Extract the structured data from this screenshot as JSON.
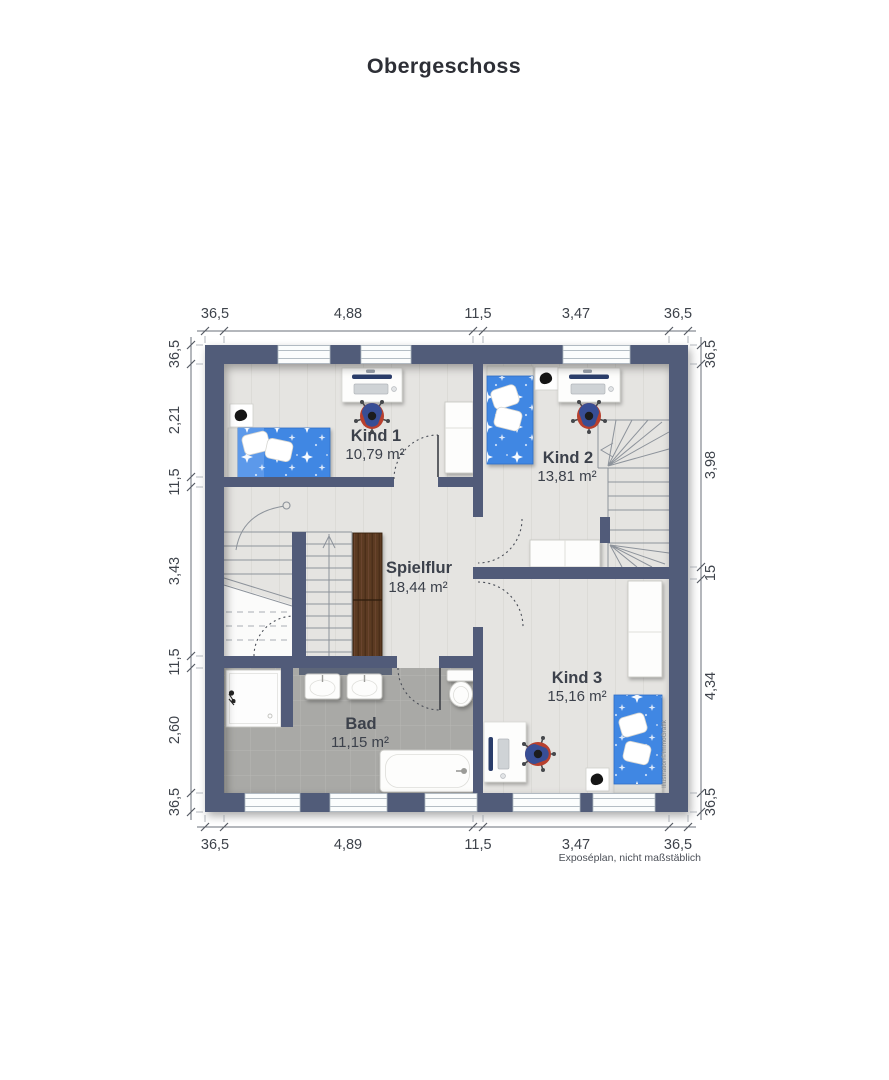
{
  "title": "Obergeschoss",
  "caption": "Exposéplan, nicht maßstäblich",
  "watermark": "Illustration©ImmoGrafik",
  "rooms": {
    "kind1": {
      "name": "Kind 1",
      "area": "10,79 m²"
    },
    "kind2": {
      "name": "Kind 2",
      "area": "13,81 m²"
    },
    "kind3": {
      "name": "Kind 3",
      "area": "15,16 m²"
    },
    "spielflur": {
      "name": "Spielflur",
      "area": "18,44 m²"
    },
    "bad": {
      "name": "Bad",
      "area": "11,15 m²"
    }
  },
  "dimensions": {
    "top": [
      "36,5",
      "4,88",
      "11,5",
      "3,47",
      "36,5"
    ],
    "bottom": [
      "36,5",
      "4,89",
      "11,5",
      "3,47",
      "36,5"
    ],
    "left": [
      "36,5",
      "2,21",
      "11,5",
      "3,43",
      "11,5",
      "2,60",
      "36,5"
    ],
    "right": [
      "36,5",
      "3,98",
      "15",
      "4,34",
      "36,5"
    ]
  },
  "colors": {
    "wall": "#515b79",
    "floor": "#e5e4e1",
    "bath_floor": "#a9a9a6",
    "bed_blue": "#4187e3",
    "wood": "#5b3a24",
    "text": "#3e434b"
  }
}
